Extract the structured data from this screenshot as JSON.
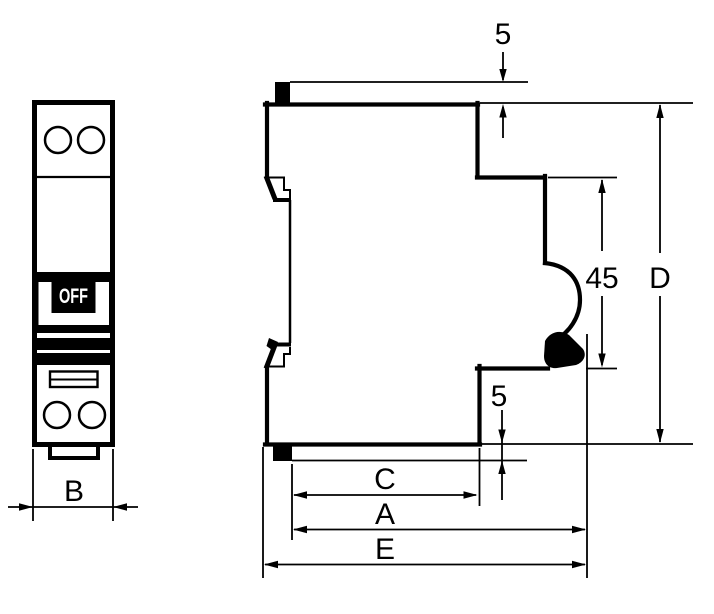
{
  "colors": {
    "ink": "#000000",
    "background": "#ffffff",
    "switch_bg": "#000000",
    "switch_text": "#ffffff"
  },
  "front_view": {
    "switch_label": "OFF",
    "width_dim": "B"
  },
  "side_view": {
    "top_offset_dim": "5",
    "rail_height_dim": "45",
    "overall_height_dim": "D",
    "bottom_offset_dim": "5",
    "depth_c_dim": "C",
    "depth_a_dim": "A",
    "depth_e_dim": "E"
  }
}
